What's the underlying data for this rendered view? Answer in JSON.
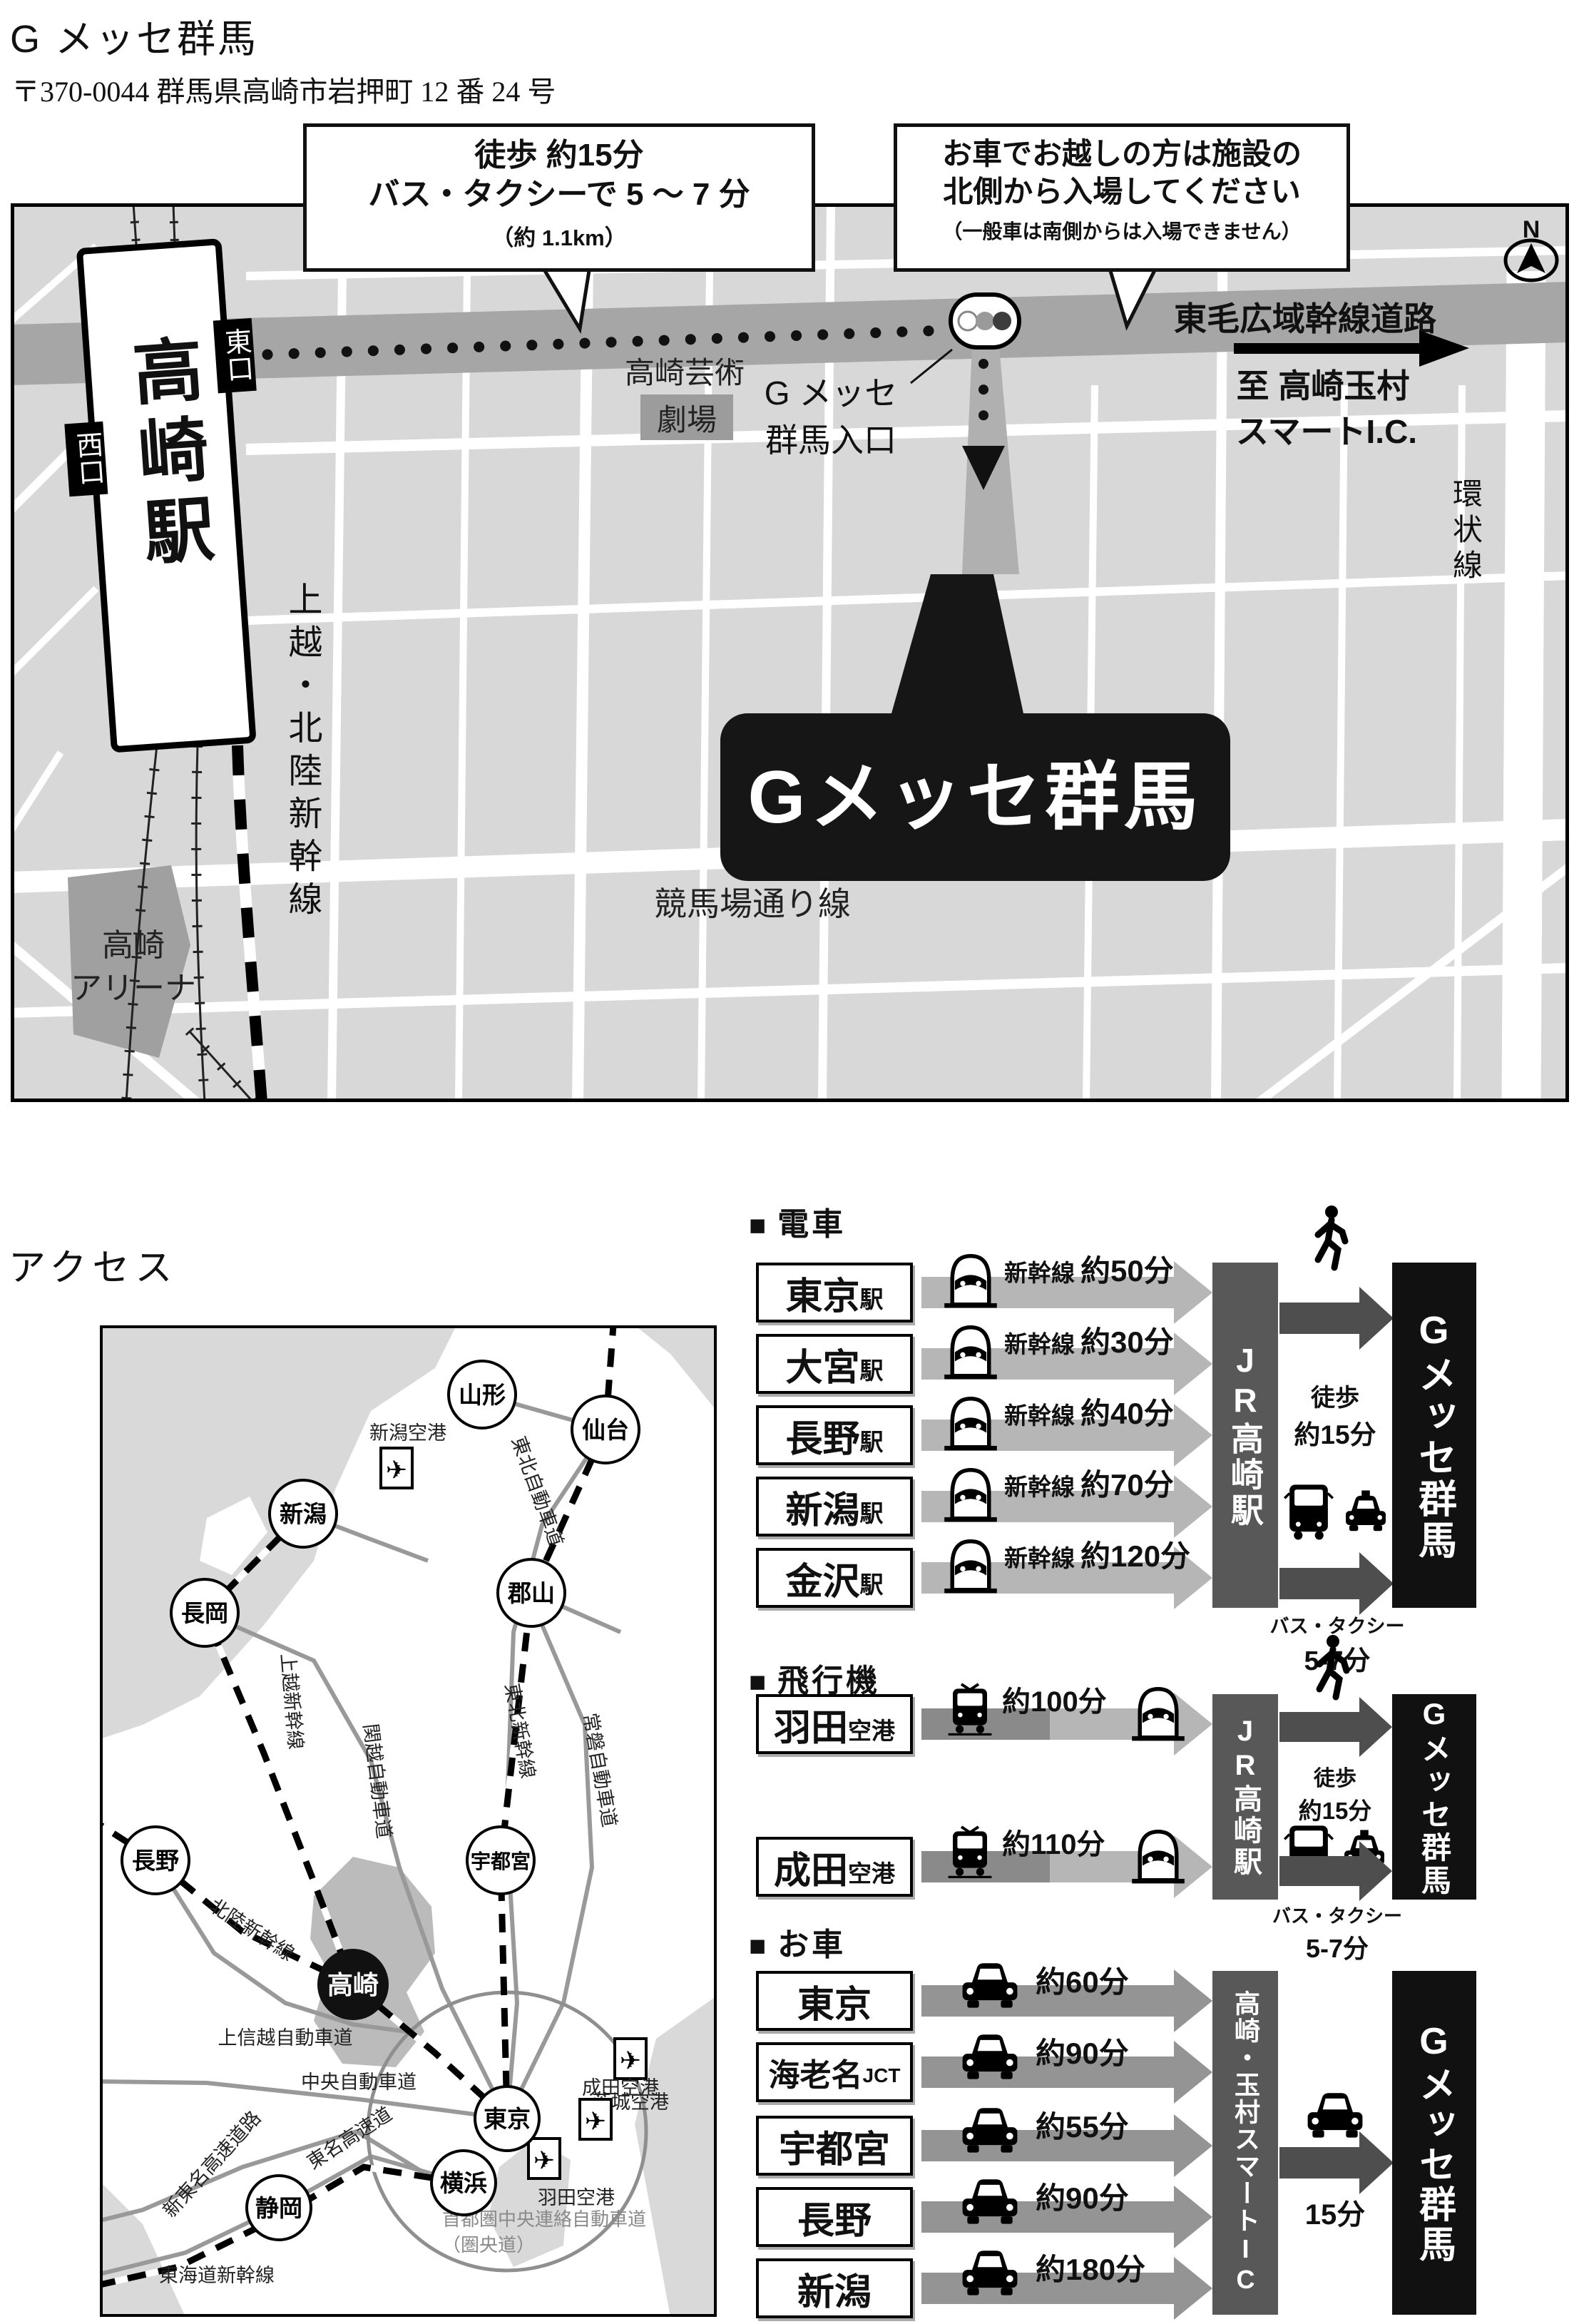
{
  "page": {
    "title": "G メッセ群馬",
    "address": "〒370-0044 群馬県高崎市岩押町 12 番 24 号"
  },
  "map": {
    "callout_walk": {
      "line1": "徒歩 約15分",
      "line2": "バス・タクシーで 5 〜 7 分",
      "line3": "（約 1.1km）"
    },
    "callout_car": {
      "line1": "お車でお越しの方は施設の",
      "line2": "北側から入場してください",
      "line3": "（一般車は南側からは入場できません）"
    },
    "station": {
      "name": "高崎駅",
      "east_exit": "東口",
      "west_exit": "西口"
    },
    "labels": {
      "main_road": "東毛広域幹線道路",
      "entrance_line1": "G メッセ",
      "entrance_line2": "群馬入口",
      "to_ic_line1": "至 高崎玉村",
      "to_ic_line2": "スマートI.C.",
      "ring_road": "環状線",
      "theater_line1": "高崎芸術",
      "theater_line2": "劇場",
      "arena_line1": "高崎",
      "arena_line2": "アリーナ",
      "rail_line": "上越・北陸新幹線",
      "keiba_road": "競馬場通り線",
      "venue": "Gメッセ群馬",
      "compass": "N"
    }
  },
  "access": {
    "heading": "アクセス",
    "regional_map": {
      "cities": [
        {
          "name": "山形"
        },
        {
          "name": "仙台"
        },
        {
          "name": "新潟"
        },
        {
          "name": "長岡"
        },
        {
          "name": "郡山"
        },
        {
          "name": "長野"
        },
        {
          "name": "宇都宮"
        },
        {
          "name": "東京"
        },
        {
          "name": "横浜"
        },
        {
          "name": "静岡"
        }
      ],
      "hub": "高崎",
      "airports": [
        {
          "name": "新潟空港"
        },
        {
          "name": "茨城空港"
        },
        {
          "name": "成田空港"
        },
        {
          "name": "羽田空港"
        }
      ],
      "roads": {
        "tohoku_exp": "東北自動車道",
        "joetsu_shink": "上越新幹線",
        "kanetsu_exp": "関越自動車道",
        "tohoku_shink": "東北新幹線",
        "joban_exp": "常磐自動車道",
        "hokuriku_shink": "北陸新幹線",
        "joshinetsu_exp": "上信越自動車道",
        "chuo_exp": "中央自動車道",
        "shin_tomei_exp": "新東名高速道路",
        "tomei_exp": "東名高速道",
        "tokaido_shink": "東海道新幹線",
        "kenodo_line1": "首都圏中央連絡自動車道",
        "kenodo_line2": "（圏央道）"
      },
      "plane_glyph": "✈"
    },
    "train": {
      "marker": "■",
      "header": "電車",
      "rows": [
        {
          "name": "東京",
          "suffix": "駅",
          "method": "新幹線",
          "time": "約50分"
        },
        {
          "name": "大宮",
          "suffix": "駅",
          "method": "新幹線",
          "time": "約30分"
        },
        {
          "name": "長野",
          "suffix": "駅",
          "method": "新幹線",
          "time": "約40分"
        },
        {
          "name": "新潟",
          "suffix": "駅",
          "method": "新幹線",
          "time": "約70分"
        },
        {
          "name": "金沢",
          "suffix": "駅",
          "method": "新幹線",
          "time": "約120分"
        }
      ],
      "hub": "JR高崎駅",
      "walk_line1": "徒歩",
      "walk_line2": "約15分",
      "bus_line1": "バス・タクシー",
      "bus_line2": "5-7分",
      "destination": "Gメッセ群馬"
    },
    "plane": {
      "marker": "■",
      "header": "飛行機",
      "rows": [
        {
          "name": "羽田",
          "suffix": "空港",
          "time": "約100分"
        },
        {
          "name": "成田",
          "suffix": "空港",
          "time": "約110分"
        }
      ],
      "hub": "JR高崎駅",
      "walk_line1": "徒歩",
      "walk_line2": "約15分",
      "bus_line1": "バス・タクシー",
      "bus_line2": "5-7分",
      "destination": "Gメッセ群馬"
    },
    "car": {
      "marker": "■",
      "header": "お車",
      "rows": [
        {
          "name": "東京",
          "suffix": "",
          "time": "約60分"
        },
        {
          "name": "海老名",
          "suffix": "JCT",
          "time": "約90分"
        },
        {
          "name": "宇都宮",
          "suffix": "",
          "time": "約55分"
        },
        {
          "name": "長野",
          "suffix": "",
          "time": "約90分"
        },
        {
          "name": "新潟",
          "suffix": "",
          "time": "約180分"
        }
      ],
      "hub": "高崎・玉村スマートIC",
      "transfer_time": "15分",
      "destination": "Gメッセ群馬"
    }
  }
}
